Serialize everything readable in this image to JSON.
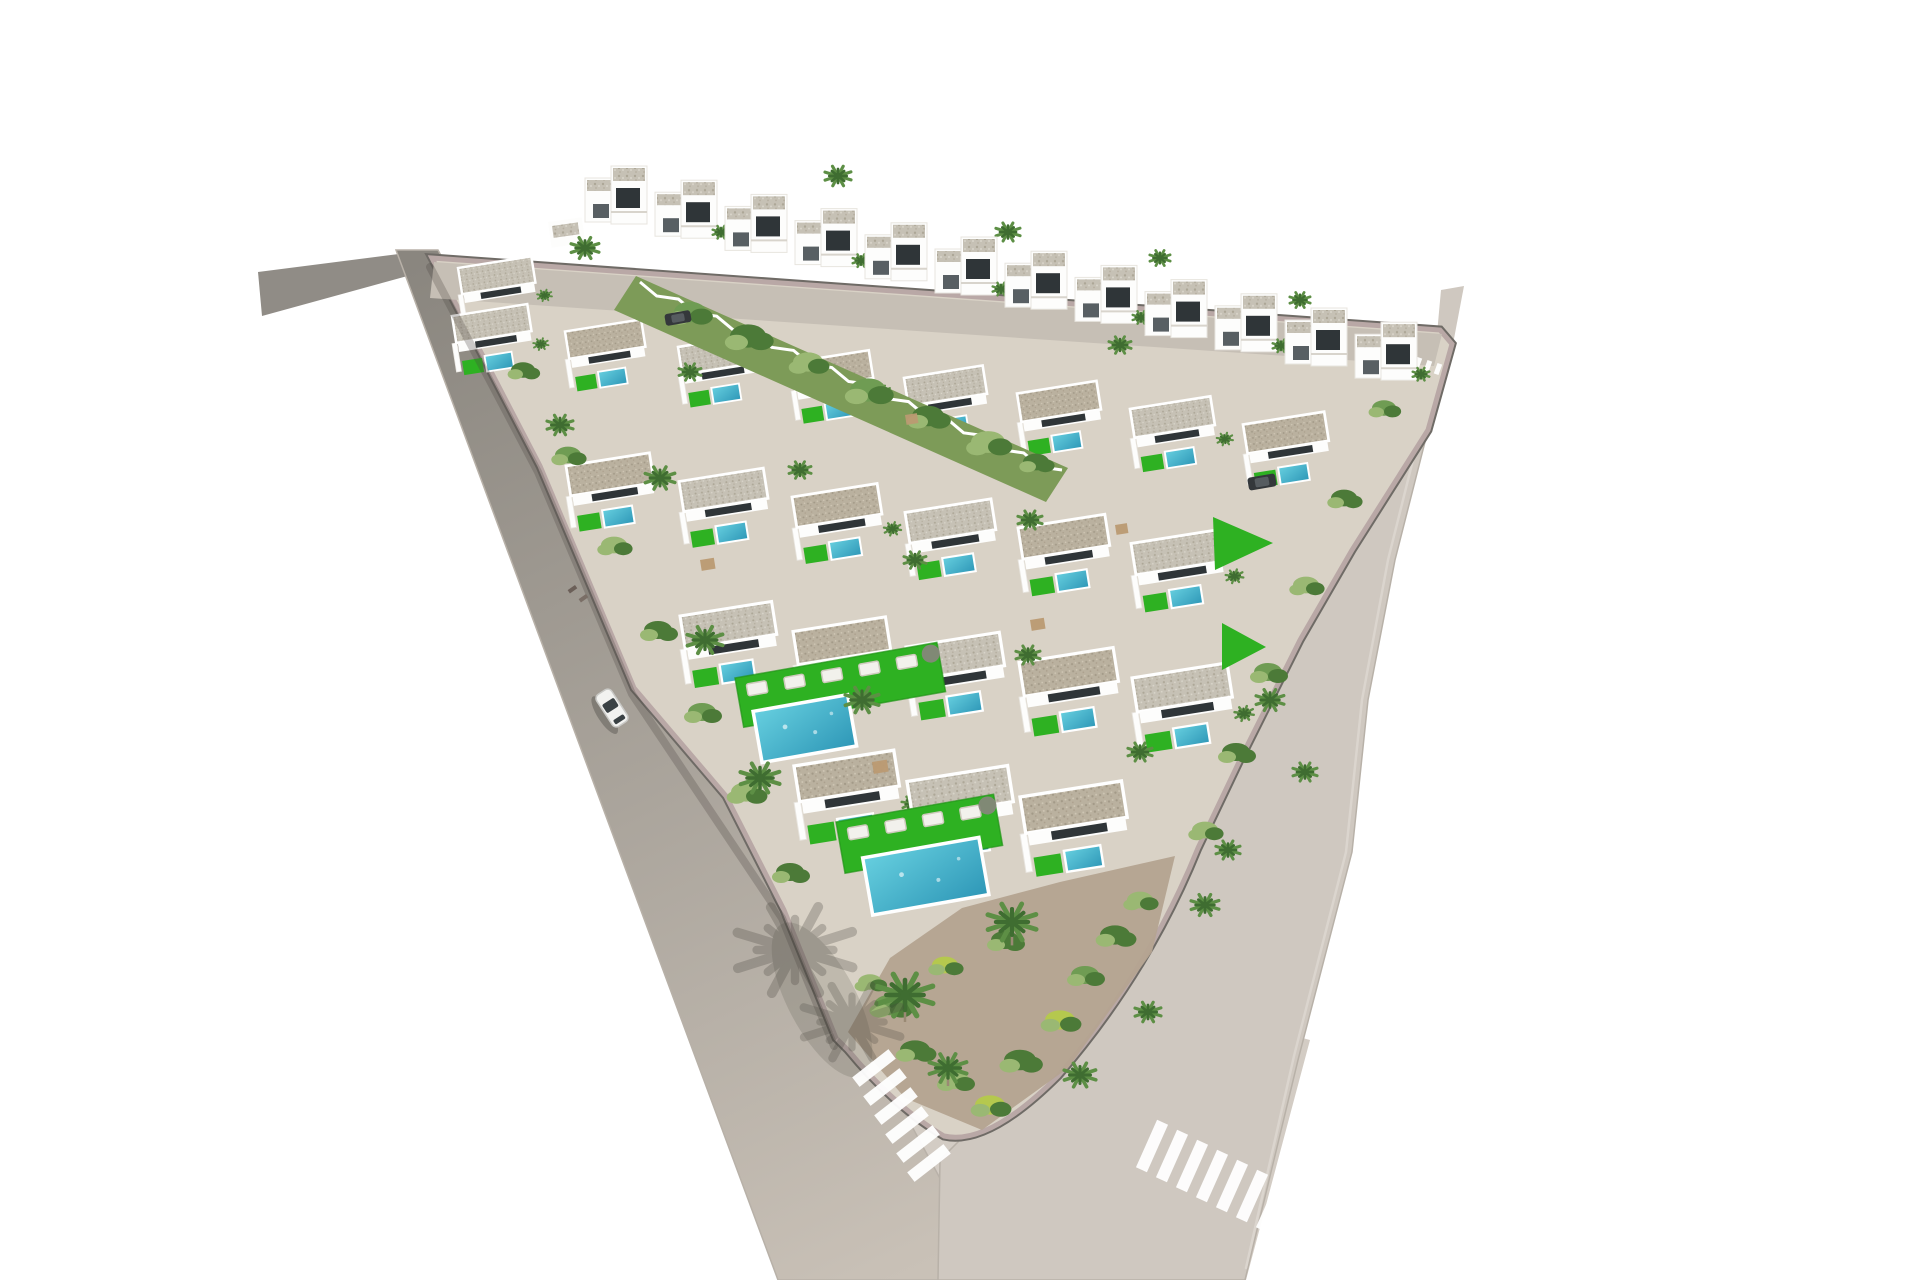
{
  "meta": {
    "description": "Aerial 3D architectural rendering of a triangular white-villa residential development with private pools, artificial green lawns, palm trees, perimeter roads, two zebra crosswalks and a white car driving on the left road",
    "width": 1920,
    "height": 1280
  },
  "palette": {
    "bg": "#ffffff",
    "roadLeftTop": "#8a867f",
    "roadLeftBottom": "#c9c1b7",
    "roadRight": "#cfc8c0",
    "roadBottom": "#d3ccc4",
    "laneLine": "#ddd7d0",
    "roadEdge": "#b8b1a8",
    "curbDark": "#6f6b66",
    "curbPink": "#b9a8a6",
    "plot": "#d9d2c6",
    "streetTop": "#c6bfb5",
    "wallWhite": "#fdfdfc",
    "wallShade": "#e8e5df",
    "glazing": "#2f3538",
    "doorDark": "#585f63",
    "poolLight": "#66cfdf",
    "poolDark": "#2e97b7",
    "lawn": "#2eb122",
    "lawnDark": "#219417",
    "bandGreen": "#7d9b58",
    "bushDark": "#4c7a38",
    "bushMid": "#6f9c53",
    "bushLight": "#9ab873",
    "bushYellow": "#b5c84e",
    "soil": "#b4a390",
    "palmMid": "#5d8f45",
    "palmDark": "#3f6d31",
    "trunk": "#9a8a74",
    "shadow": "#4a463f",
    "carBody": "#f2f2f0",
    "carGlass": "#3a4144",
    "darkCar": "#34383b",
    "wood": "#bb9a72",
    "lounger": "#f2f1ec",
    "loungerEdge": "#cfcabe",
    "roofGravelBase": "#c6c1b5",
    "roofSandBase": "#bab19f"
  },
  "generator": {
    "cols": 9,
    "x0": 452,
    "y0": 316,
    "colDx": 113,
    "colDy": 15.5,
    "maxK": 6,
    "stepX": 114,
    "stepY": 150,
    "leftLine": [
      432,
      258,
      965,
      1145
    ],
    "rightLine": [
      1448,
      342,
      967,
      1147
    ],
    "leftMargin": -15000,
    "rightMargin": 15000,
    "apexCx": 952,
    "apexCy": 1028,
    "apexR": 150,
    "yMax": 1120,
    "scaleBase": 0.7,
    "scalePerY": 0.00052,
    "rot": -9
  },
  "layers": [
    {
      "t": "poly",
      "name": "road-left-stub",
      "pts": [
        [
          258,
          272
        ],
        [
          430,
          250
        ],
        [
          444,
          266
        ],
        [
          262,
          316
        ]
      ],
      "fill": "$roadLeftTop",
      "op": 0.95
    },
    {
      "t": "poly",
      "name": "road-bottom",
      "pts": [
        [
          742,
          1060
        ],
        [
          965,
          1085
        ],
        [
          1160,
          1000
        ],
        [
          1310,
          1040
        ],
        [
          1246,
          1280
        ],
        [
          783,
          1280
        ]
      ],
      "fill": "$roadBottom"
    },
    {
      "t": "poly",
      "name": "road-left",
      "pts": [
        [
          396,
          250
        ],
        [
          438,
          250
        ],
        [
          995,
          1280
        ],
        [
          778,
          1280
        ]
      ],
      "fill": "url(#gradLeft)",
      "stroke": "$roadEdge",
      "sw": 1.5,
      "op": 1
    },
    {
      "t": "poly",
      "name": "road-right",
      "pts": [
        [
          1437,
          332
        ],
        [
          1452,
          342
        ],
        [
          1428,
          430
        ],
        [
          1395,
          560
        ],
        [
          1368,
          700
        ],
        [
          1352,
          852
        ],
        [
          1298,
          1060
        ],
        [
          1245,
          1280
        ],
        [
          938,
          1280
        ],
        [
          940,
          1160
        ],
        [
          1020,
          1080
        ],
        [
          1140,
          950
        ],
        [
          1240,
          760
        ],
        [
          1300,
          640
        ],
        [
          1360,
          540
        ],
        [
          1408,
          420
        ]
      ],
      "fill": "$roadRight",
      "stroke": "$roadEdge",
      "sw": 1.5
    },
    {
      "t": "poly",
      "name": "road-right-stub",
      "pts": [
        [
          1437,
          334
        ],
        [
          1441,
          290
        ],
        [
          1464,
          286
        ],
        [
          1453,
          344
        ]
      ],
      "fill": "$roadRight"
    },
    {
      "t": "path",
      "name": "lane-edge-line",
      "d": "M1444,352 L1420,432 L1388,560 L1362,700 L1346,852 L1294,1056 L1246,1268",
      "stroke": "$laneLine",
      "sw": 2.5,
      "fill": "none",
      "op": 0.85
    },
    {
      "t": "path",
      "name": "plot-curb-wall",
      "d": "M432,258 L1440,330 L1452,344 L1428,430 L1352,550 L1300,640 L1240,760 L1198,848 Q1148,972 1058,1076 Q988,1146 944,1136 Q896,1108 848,1050 L836,1038 L784,910 L726,796 L634,688 L540,466 Z",
      "stroke": "$curbDark",
      "sw": 9,
      "fill": "none"
    },
    {
      "t": "path",
      "name": "plot-ground",
      "d": "M432,258 L1440,330 L1452,344 L1428,430 L1352,550 L1300,640 L1240,760 L1198,848 Q1148,972 1058,1076 Q988,1146 944,1136 Q896,1108 848,1050 L836,1038 L784,910 L726,796 L634,688 L540,466 Z",
      "stroke": "$curbPink",
      "sw": 5,
      "fill": "$plot"
    },
    {
      "t": "poly",
      "name": "street-top",
      "pts": [
        [
          434,
          262
        ],
        [
          1442,
          334
        ],
        [
          1434,
          366
        ],
        [
          430,
          298
        ]
      ],
      "fill": "$streetTop"
    },
    {
      "t": "villa",
      "name": "villa-corner",
      "x": 458,
      "y": 268,
      "s": 0.7,
      "pool": false,
      "palm": true
    },
    {
      "t": "villas",
      "name": "villa-grid"
    },
    {
      "t": "rect",
      "name": "entrance-kiosk",
      "x": 548,
      "y": 222,
      "w": 34,
      "h": 26,
      "fill": "$wallWhite",
      "rot": -8
    },
    {
      "t": "rect",
      "name": "entrance-kiosk-roof",
      "x": 552,
      "y": 226,
      "w": 26,
      "h": 12,
      "fill": "url(#grav1)",
      "rot": -8
    },
    {
      "t": "terrace",
      "name": "terrace-feature-upper",
      "x": 735,
      "y": 678,
      "rot": -10,
      "lawnW": 205,
      "lawnH": 50,
      "pool": [
        12,
        36,
        96,
        52
      ],
      "loungers": 5,
      "parasol": true
    },
    {
      "t": "terrace",
      "name": "terrace-feature-apex",
      "x": 836,
      "y": 822,
      "rot": -10,
      "lawnW": 160,
      "lawnH": 52,
      "pool": [
        20,
        40,
        118,
        58
      ],
      "loungers": 4,
      "parasol": true
    },
    {
      "t": "poly",
      "name": "triangle-lawn-1",
      "pts": [
        [
          1213,
          517
        ],
        [
          1273,
          543
        ],
        [
          1215,
          570
        ]
      ],
      "fill": "$lawn"
    },
    {
      "t": "poly",
      "name": "triangle-lawn-2",
      "pts": [
        [
          1222,
          623
        ],
        [
          1266,
          647
        ],
        [
          1222,
          670
        ]
      ],
      "fill": "$lawn"
    },
    {
      "t": "poly",
      "name": "community-garden-band",
      "pts": [
        [
          636,
          276
        ],
        [
          1068,
          468
        ],
        [
          1046,
          502
        ],
        [
          614,
          310
        ]
      ],
      "fill": "$bandGreen"
    },
    {
      "t": "sawtooth",
      "name": "garden-fence",
      "x1": 640,
      "y1": 282,
      "x2": 1062,
      "y2": 470,
      "n": 22,
      "amp": 6
    },
    {
      "t": "bush",
      "name": "band-bush",
      "x": 690,
      "y": 312,
      "r": 16,
      "v": 0
    },
    {
      "t": "bush",
      "name": "band-bush",
      "x": 748,
      "y": 336,
      "r": 18,
      "v": 1
    },
    {
      "t": "bush",
      "name": "band-bush",
      "x": 808,
      "y": 362,
      "r": 15,
      "v": 2
    },
    {
      "t": "bush",
      "name": "band-bush",
      "x": 868,
      "y": 390,
      "r": 18,
      "v": 0
    },
    {
      "t": "bush",
      "name": "band-bush",
      "x": 928,
      "y": 416,
      "r": 16,
      "v": 1
    },
    {
      "t": "bush",
      "name": "band-bush",
      "x": 988,
      "y": 442,
      "r": 17,
      "v": 2
    },
    {
      "t": "bush",
      "name": "band-bush",
      "x": 1036,
      "y": 462,
      "r": 13,
      "v": 1
    },
    {
      "t": "poly",
      "name": "apex-garden-soil",
      "pts": [
        [
          848,
          1032
        ],
        [
          890,
          958
        ],
        [
          962,
          908
        ],
        [
          1060,
          882
        ],
        [
          1175,
          856
        ],
        [
          1152,
          952
        ],
        [
          1068,
          1068
        ],
        [
          982,
          1130
        ],
        [
          905,
          1098
        ]
      ],
      "fill": "$soil",
      "op": 0.95
    },
    {
      "t": "bush",
      "name": "apex-bush",
      "x": 890,
      "y": 1005,
      "r": 16,
      "v": 0
    },
    {
      "t": "bush",
      "name": "apex-bush",
      "x": 915,
      "y": 1050,
      "r": 15,
      "v": 1
    },
    {
      "t": "bush",
      "name": "apex-bush",
      "x": 955,
      "y": 1080,
      "r": 14,
      "v": 2
    },
    {
      "t": "bush",
      "name": "apex-bush",
      "x": 990,
      "y": 1105,
      "r": 15,
      "v": 3
    },
    {
      "t": "bush",
      "name": "apex-bush",
      "x": 1020,
      "y": 1060,
      "r": 16,
      "v": 1
    },
    {
      "t": "bush",
      "name": "apex-bush",
      "x": 1060,
      "y": 1020,
      "r": 15,
      "v": 3
    },
    {
      "t": "bush",
      "name": "apex-bush",
      "x": 1085,
      "y": 975,
      "r": 14,
      "v": 0
    },
    {
      "t": "bush",
      "name": "apex-bush",
      "x": 1115,
      "y": 935,
      "r": 15,
      "v": 1
    },
    {
      "t": "bush",
      "name": "apex-bush",
      "x": 1140,
      "y": 900,
      "r": 13,
      "v": 2
    },
    {
      "t": "bush",
      "name": "apex-bush",
      "x": 945,
      "y": 965,
      "r": 13,
      "v": 3
    },
    {
      "t": "bush",
      "name": "apex-bush",
      "x": 1005,
      "y": 940,
      "r": 14,
      "v": 1
    },
    {
      "t": "bush",
      "name": "apex-bush",
      "x": 870,
      "y": 982,
      "r": 12,
      "v": 2
    },
    {
      "t": "bush",
      "name": "edge-bush",
      "x": 523,
      "y": 370,
      "r": 12,
      "v": 1
    },
    {
      "t": "bush",
      "name": "edge-bush",
      "x": 568,
      "y": 455,
      "r": 13,
      "v": 0
    },
    {
      "t": "bush",
      "name": "edge-bush",
      "x": 614,
      "y": 545,
      "r": 13,
      "v": 2
    },
    {
      "t": "bush",
      "name": "edge-bush",
      "x": 658,
      "y": 630,
      "r": 14,
      "v": 1
    },
    {
      "t": "bush",
      "name": "edge-bush",
      "x": 702,
      "y": 712,
      "r": 14,
      "v": 0
    },
    {
      "t": "bush",
      "name": "edge-bush",
      "x": 746,
      "y": 792,
      "r": 15,
      "v": 2
    },
    {
      "t": "bush",
      "name": "edge-bush",
      "x": 790,
      "y": 872,
      "r": 14,
      "v": 1
    },
    {
      "t": "bush",
      "name": "edge-bush",
      "x": 1384,
      "y": 408,
      "r": 12,
      "v": 0
    },
    {
      "t": "bush",
      "name": "edge-bush",
      "x": 1344,
      "y": 498,
      "r": 13,
      "v": 1
    },
    {
      "t": "bush",
      "name": "edge-bush",
      "x": 1306,
      "y": 585,
      "r": 13,
      "v": 2
    },
    {
      "t": "bush",
      "name": "edge-bush",
      "x": 1268,
      "y": 672,
      "r": 14,
      "v": 0
    },
    {
      "t": "bush",
      "name": "edge-bush",
      "x": 1236,
      "y": 752,
      "r": 14,
      "v": 1
    },
    {
      "t": "bush",
      "name": "edge-bush",
      "x": 1205,
      "y": 830,
      "r": 13,
      "v": 2
    },
    {
      "t": "rect",
      "name": "pergola",
      "x": 700,
      "y": 560,
      "w": 14,
      "h": 11,
      "fill": "$wood",
      "rot": -9,
      "op": 0.95
    },
    {
      "t": "rect",
      "name": "pergola",
      "x": 905,
      "y": 415,
      "w": 12,
      "h": 10,
      "fill": "$wood",
      "rot": -9,
      "op": 0.95
    },
    {
      "t": "rect",
      "name": "pergola",
      "x": 1030,
      "y": 620,
      "w": 14,
      "h": 11,
      "fill": "$wood",
      "rot": -9,
      "op": 0.95
    },
    {
      "t": "rect",
      "name": "pergola",
      "x": 872,
      "y": 762,
      "w": 15,
      "h": 12,
      "fill": "$wood",
      "rot": -9,
      "op": 0.95
    },
    {
      "t": "rect",
      "name": "pergola",
      "x": 1115,
      "y": 525,
      "w": 12,
      "h": 10,
      "fill": "$wood",
      "rot": -9,
      "op": 0.95
    },
    {
      "t": "palm",
      "name": "palm-tree",
      "x": 585,
      "y": 248,
      "r": 15
    },
    {
      "t": "palm",
      "name": "palm-tree",
      "x": 625,
      "y": 210,
      "r": 13
    },
    {
      "t": "palm",
      "name": "palm-tree",
      "x": 838,
      "y": 176,
      "r": 14
    },
    {
      "t": "palm",
      "name": "palm-tree",
      "x": 1008,
      "y": 232,
      "r": 13
    },
    {
      "t": "palm",
      "name": "palm-tree",
      "x": 1160,
      "y": 258,
      "r": 11
    },
    {
      "t": "palm",
      "name": "palm-tree",
      "x": 1300,
      "y": 300,
      "r": 11
    },
    {
      "t": "palm",
      "name": "palm-tree",
      "x": 705,
      "y": 640,
      "r": 19
    },
    {
      "t": "palm",
      "name": "palm-tree",
      "x": 760,
      "y": 778,
      "r": 21
    },
    {
      "t": "palm",
      "name": "palm-tree",
      "x": 862,
      "y": 700,
      "r": 18
    },
    {
      "t": "palm",
      "name": "palm-tree",
      "x": 660,
      "y": 478,
      "r": 16
    },
    {
      "t": "palm",
      "name": "palm-tree",
      "x": 560,
      "y": 425,
      "r": 14
    },
    {
      "t": "palm",
      "name": "palm-tree",
      "x": 1120,
      "y": 345,
      "r": 12
    },
    {
      "t": "palm",
      "name": "palm-tree",
      "x": 1030,
      "y": 520,
      "r": 13
    },
    {
      "t": "palm",
      "name": "palm-big",
      "x": 905,
      "y": 995,
      "r": 30,
      "trunk": true
    },
    {
      "t": "palm",
      "name": "palm-big",
      "x": 1012,
      "y": 922,
      "r": 26,
      "trunk": true
    },
    {
      "t": "palm",
      "name": "palm-big",
      "x": 948,
      "y": 1068,
      "r": 20,
      "trunk": true
    },
    {
      "t": "palm",
      "name": "palm-tree",
      "x": 1270,
      "y": 700,
      "r": 15
    },
    {
      "t": "palm",
      "name": "palm-tree",
      "x": 1305,
      "y": 772,
      "r": 13
    },
    {
      "t": "palm",
      "name": "palm-tree",
      "x": 1205,
      "y": 905,
      "r": 15
    },
    {
      "t": "palm",
      "name": "palm-tree",
      "x": 1080,
      "y": 1075,
      "r": 17
    },
    {
      "t": "palm",
      "name": "palm-tree",
      "x": 1148,
      "y": 1012,
      "r": 14
    },
    {
      "t": "palm",
      "name": "palm-tree",
      "x": 690,
      "y": 372,
      "r": 12
    },
    {
      "t": "palm",
      "name": "palm-tree",
      "x": 800,
      "y": 470,
      "r": 12
    },
    {
      "t": "palm",
      "name": "palm-tree",
      "x": 915,
      "y": 560,
      "r": 12
    },
    {
      "t": "palm",
      "name": "palm-tree",
      "x": 1028,
      "y": 655,
      "r": 13
    },
    {
      "t": "palm",
      "name": "palm-tree",
      "x": 1140,
      "y": 752,
      "r": 13
    },
    {
      "t": "palm",
      "name": "palm-tree",
      "x": 1228,
      "y": 850,
      "r": 13
    },
    {
      "t": "path",
      "name": "wall-shadow-left-road",
      "d": "M430,267 L538,472 L632,694 L782,918 L834,1046",
      "stroke": "$shadow",
      "sw": 8,
      "fill": "none",
      "op": 0.28
    },
    {
      "t": "palm",
      "name": "palm-shadow",
      "x": 795,
      "y": 950,
      "r": 62,
      "col": "$shadow",
      "op": 0.28
    },
    {
      "t": "palm",
      "name": "palm-shadow",
      "x": 852,
      "y": 1022,
      "r": 52,
      "col": "$shadow",
      "op": 0.25
    },
    {
      "t": "ell",
      "name": "shadow-blob",
      "cx": 822,
      "cy": 1000,
      "rx": 86,
      "ry": 34,
      "fill": "$shadow",
      "op": 0.18,
      "rot": 62
    },
    {
      "t": "car",
      "name": "white-car",
      "x": 612,
      "y": 708,
      "rot": 57
    },
    {
      "t": "darkcar",
      "name": "parked-dark-car",
      "x": 678,
      "y": 318,
      "rot": -10,
      "w": 26,
      "h": 12
    },
    {
      "t": "darkcar",
      "name": "parked-dark-car",
      "x": 1262,
      "y": 482,
      "rot": -10,
      "w": 28,
      "h": 13
    },
    {
      "t": "rect",
      "name": "pedestrian",
      "x": 575,
      "y": 585,
      "w": 4,
      "h": 9,
      "fill": "#6b5f58",
      "rot": 55
    },
    {
      "t": "rect",
      "name": "pedestrian",
      "x": 586,
      "y": 594,
      "w": 4,
      "h": 9,
      "fill": "#7a6e66",
      "rot": 55
    },
    {
      "t": "zebra",
      "name": "crosswalk-left",
      "x": 874,
      "y": 1068,
      "dx": 11,
      "dy": 19,
      "n": 6,
      "w": 46,
      "h": 12,
      "rot": -38
    },
    {
      "t": "zebra",
      "name": "crosswalk-right",
      "x": 1152,
      "y": 1146,
      "dx": 20,
      "dy": 10,
      "n": 7,
      "w": 12,
      "h": 52,
      "rot": 24
    },
    {
      "t": "zebra",
      "name": "giveway-dashes",
      "x": 1408,
      "y": 360,
      "dx": 10,
      "dy": 3,
      "n": 4,
      "w": 5,
      "h": 11,
      "rot": 20
    }
  ],
  "top_row": {
    "count": 12,
    "x0": 585,
    "y0": 166,
    "dx": 70,
    "dy": 14.2
  }
}
